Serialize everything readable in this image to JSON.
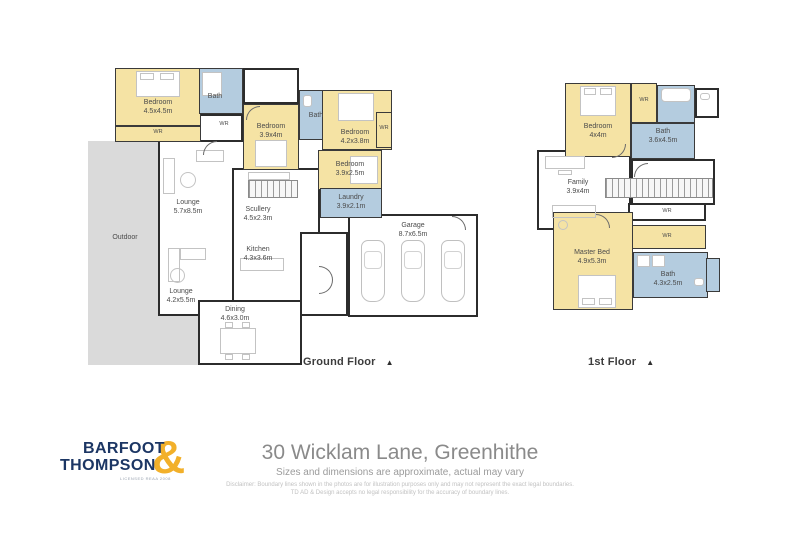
{
  "labels": {
    "wr": "WR"
  },
  "ground": {
    "caption": "Ground Floor",
    "marker": "▲",
    "rooms": [
      {
        "name": "Bedroom",
        "dims": "4.5x4.5m"
      },
      {
        "name": "Bath",
        "dims": ""
      },
      {
        "name": "Bedroom",
        "dims": "3.9x4m"
      },
      {
        "name": "Bath",
        "dims": ""
      },
      {
        "name": "Bedroom",
        "dims": "4.2x3.8m"
      },
      {
        "name": "Bedroom",
        "dims": "3.9x2.5m"
      },
      {
        "name": "Laundry",
        "dims": "3.9x2.1m"
      },
      {
        "name": "Lounge",
        "dims": "5.7x8.5m"
      },
      {
        "name": "Scullery",
        "dims": "4.5x2.3m"
      },
      {
        "name": "Kitchen",
        "dims": "4.3x3.6m"
      },
      {
        "name": "Lounge",
        "dims": "4.2x5.5m"
      },
      {
        "name": "Dining",
        "dims": "4.6x3.0m"
      },
      {
        "name": "Garage",
        "dims": "8.7x6.5m"
      },
      {
        "name": "Outdoor",
        "dims": ""
      }
    ]
  },
  "first": {
    "caption": "1st Floor",
    "marker": "▲",
    "rooms": [
      {
        "name": "Bedroom",
        "dims": "4x4m"
      },
      {
        "name": "Bath",
        "dims": "3.6x4.5m"
      },
      {
        "name": "Family",
        "dims": "3.9x4m"
      },
      {
        "name": "Master Bed",
        "dims": "4.9x5.3m"
      },
      {
        "name": "Bath",
        "dims": "4.3x2.5m"
      }
    ]
  },
  "footer": {
    "logo_line1": "BARFOOT",
    "logo_line2": "THOMPSON",
    "logo_amp": "&",
    "logo_tagline": "LICENSED REAA 2008",
    "title": "30 Wicklam Lane, Greenhithe",
    "subtitle": "Sizes and dimensions are approximate, actual may vary",
    "disclaimer1": "Disclaimer: Boundary lines shown in the photos are for illustration purposes only and may not represent the exact legal boundaries.",
    "disclaimer2": "TD AD & Design accepts no legal responsibility for the accuracy of boundary lines."
  }
}
